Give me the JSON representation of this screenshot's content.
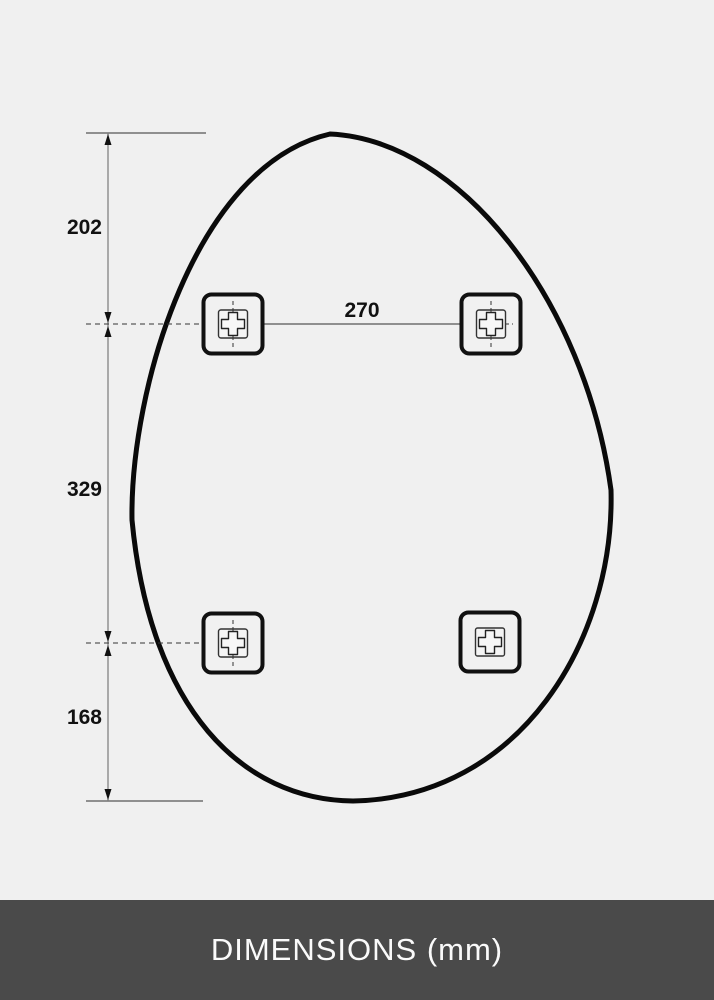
{
  "diagram": {
    "type": "product-dimension-diagram",
    "shape": "organic-oval-mirror-outline",
    "vertical_dimensions": {
      "top": "202",
      "middle": "329",
      "bottom": "168"
    },
    "horizontal_dimension": "270",
    "mounting_brackets": {
      "count": 4,
      "positions": [
        "top-left",
        "top-right",
        "bottom-left",
        "bottom-right"
      ]
    }
  },
  "footer": {
    "label": "DIMENSIONS (mm)"
  },
  "colors": {
    "background": "#f0f0f0",
    "outline": "#0a0a0a",
    "dimension_lines": "#5a5a5a",
    "footer_background": "#4a4a4a",
    "footer_text": "#fafafa"
  }
}
